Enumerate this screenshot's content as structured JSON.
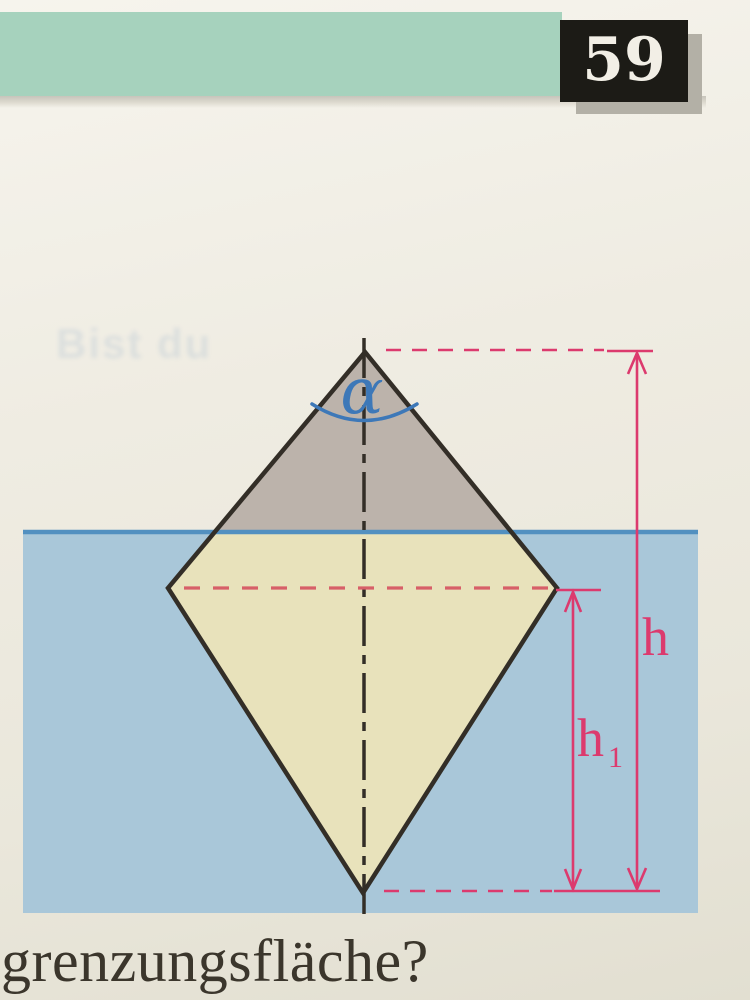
{
  "header": {
    "page_number": "59"
  },
  "ghost_text": "Bist du",
  "figure": {
    "alpha_label": "α",
    "h_label": "h",
    "h1_label_base": "h",
    "h1_label_sub": "1"
  },
  "footer": {
    "text_fragment": "grenzungsfläche?"
  },
  "colors": {
    "band_green": "#a6d2bd",
    "box_black": "#1c1b16",
    "number_white": "#f2efe6",
    "shadow_gray": "#b3b0a6",
    "water_blue": "#a9c7d9",
    "waterline_blue": "#5290c0",
    "body_above_water": "#bcb3ab",
    "body_below_water": "#e8e2bb",
    "outline_dark": "#332e27",
    "dimension_pink": "#dc3a6e",
    "mid_dash_red": "#d75f68",
    "angle_blue": "#3d78b8"
  }
}
